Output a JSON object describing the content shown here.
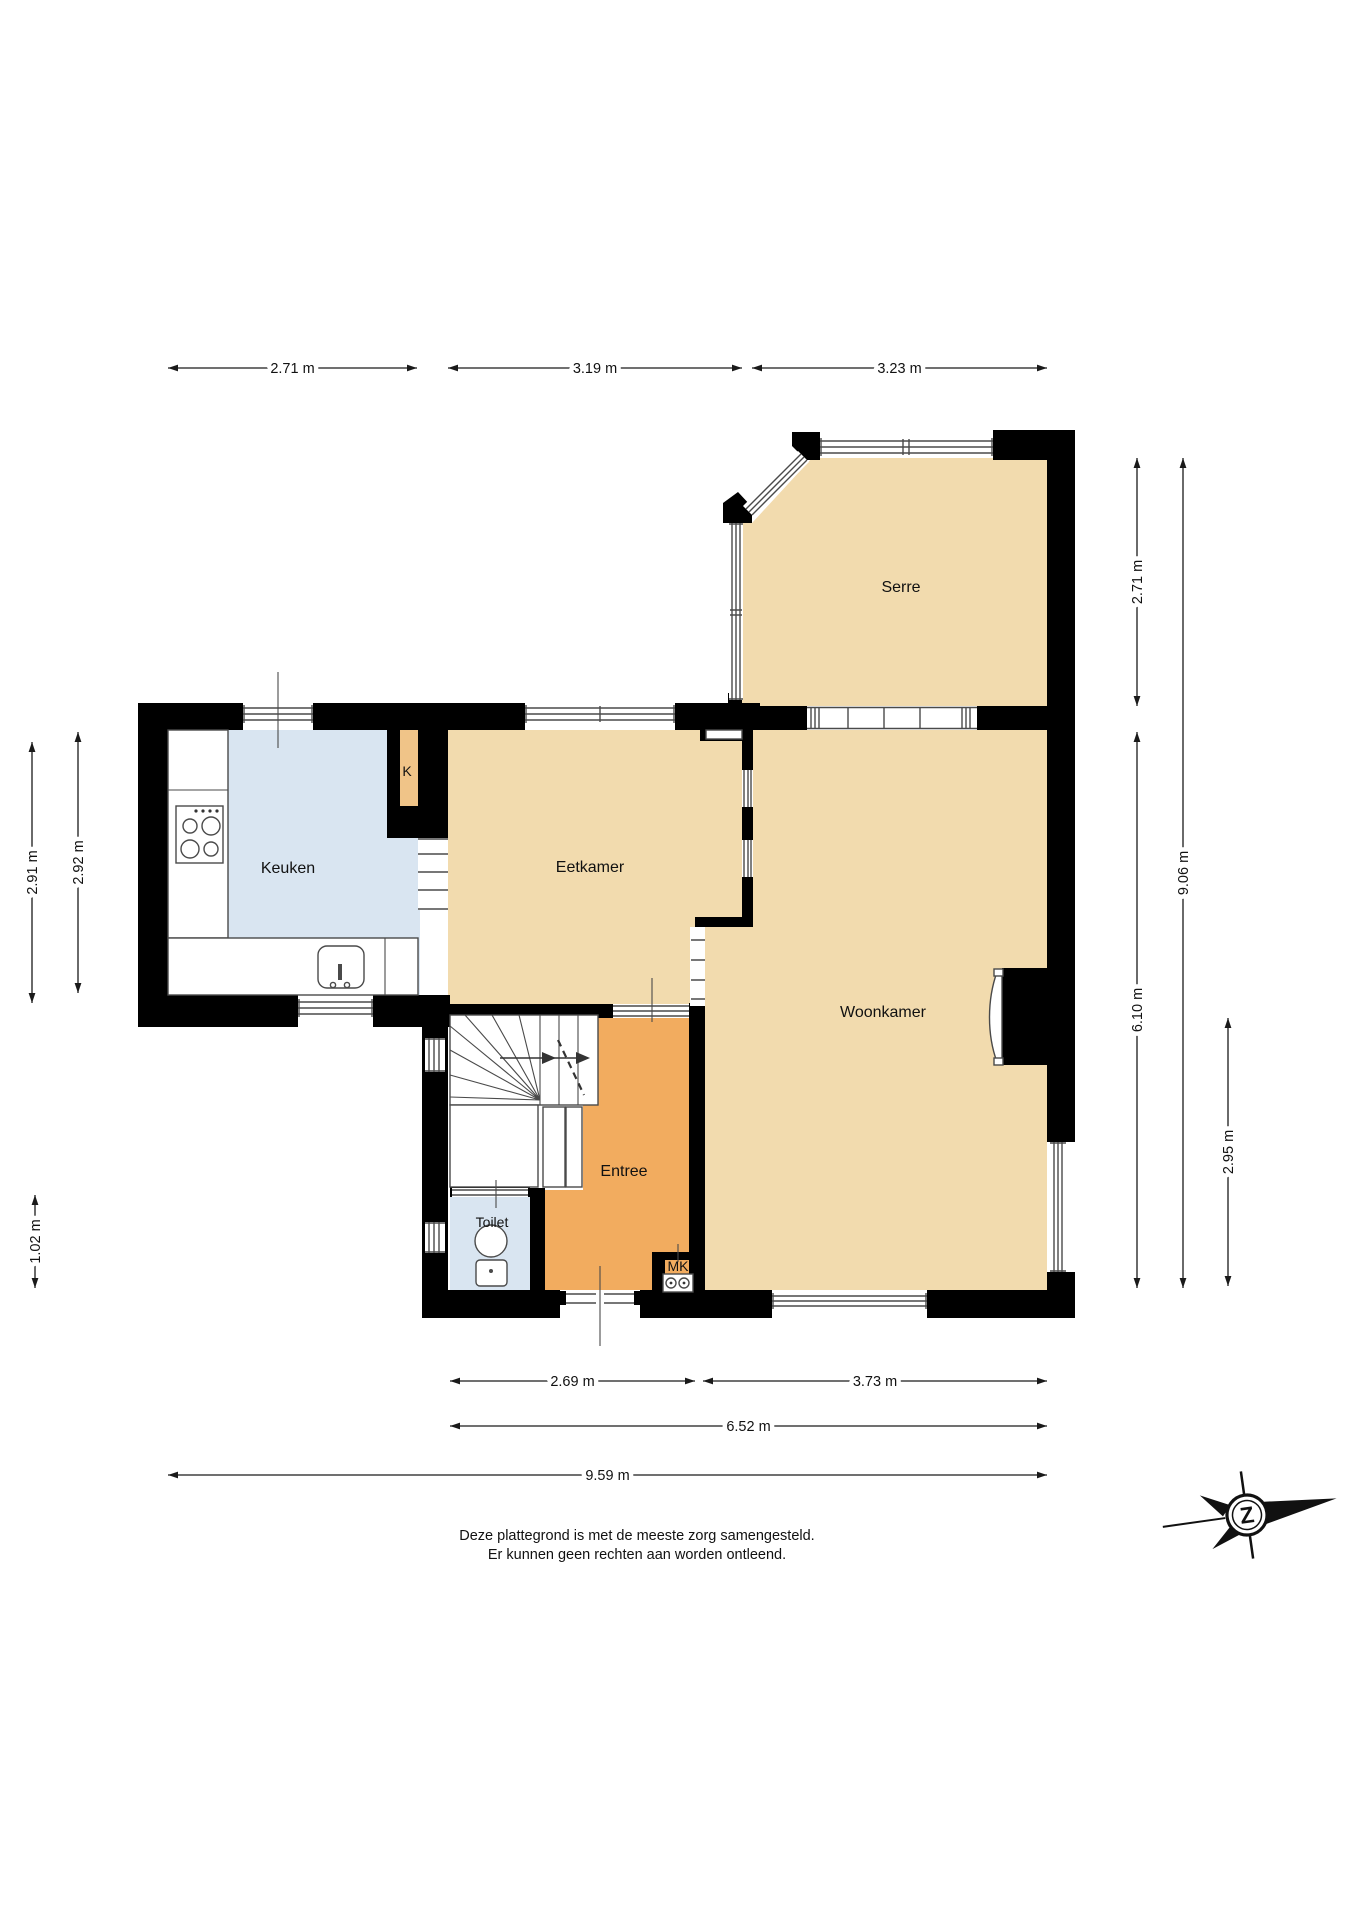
{
  "rooms": {
    "serre": "Serre",
    "keuken": "Keuken",
    "eetkamer": "Eetkamer",
    "woonkamer": "Woonkamer",
    "entree": "Entree",
    "toilet": "Toilet",
    "closet": "K",
    "meter_closet": "MK"
  },
  "dimensions": {
    "top": [
      "2.71 m",
      "3.19 m",
      "3.23 m"
    ],
    "left": [
      "2.91 m",
      "2.92 m",
      "1.02 m"
    ],
    "right": [
      "2.71 m",
      "9.06 m",
      "6.10 m",
      "2.95 m"
    ],
    "bottom": [
      "2.69 m",
      "3.73 m",
      "6.52 m",
      "9.59 m"
    ]
  },
  "disclaimer": {
    "line1": "Deze plattegrond is met de meeste zorg samengesteld.",
    "line2": "Er kunnen geen rechten aan worden ontleend."
  },
  "compass": {
    "letter": "Z"
  },
  "colors": {
    "floor_tan": "#F2DBAE",
    "floor_blue": "#D9E5F1",
    "floor_orange": "#F2AC5F",
    "floor_closet": "#F0C488",
    "wall": "#000000"
  }
}
